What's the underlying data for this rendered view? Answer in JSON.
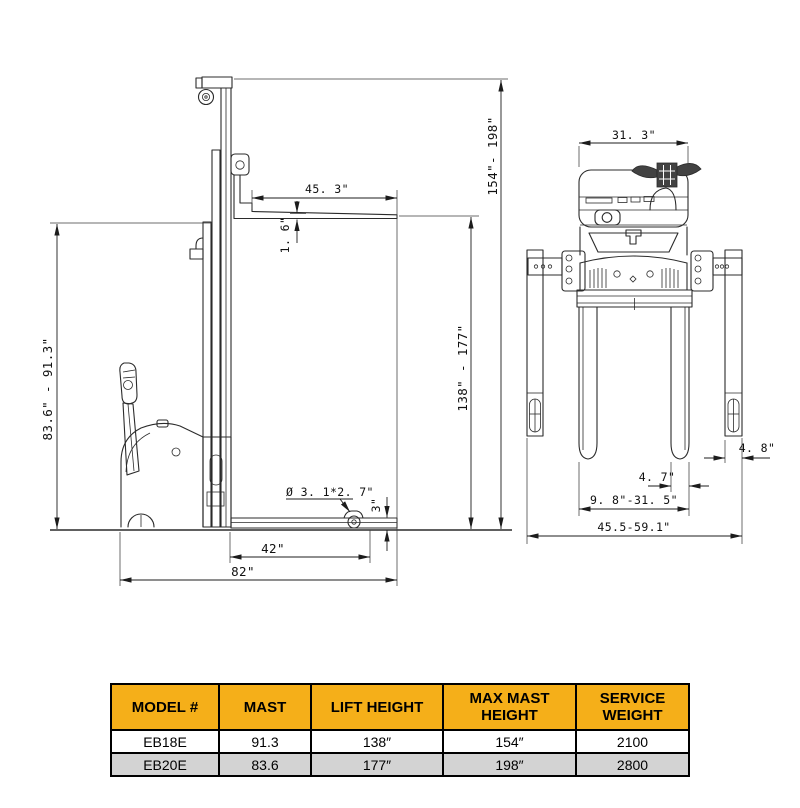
{
  "table": {
    "header_bg": "#F5AF19",
    "row_alt_bg": "#D3D3D3",
    "columns": [
      "MODEL #",
      "MAST",
      "LIFT HEIGHT",
      "MAX MAST HEIGHT",
      "SERVICE WEIGHT"
    ],
    "rows": [
      [
        "EB18E",
        "91.3",
        "138″",
        "154″",
        "2100"
      ],
      [
        "EB20E",
        "83.6",
        "177″",
        "198″",
        "2800"
      ]
    ]
  },
  "diagram": {
    "line_color": "#2b2b2b",
    "side": {
      "mast_height": "83.6\" - 91.3\"",
      "fork_length": "45. 3\"",
      "fork_thickness": "1. 6\"",
      "max_mast_height": "154\"- 198\"",
      "lift_height": "138\" - 177\"",
      "caster_size": "Ø 3. 1*2. 7\"",
      "lowered_fork_height": "3\"",
      "leg_length": "42\"",
      "overall_length": "82\""
    },
    "front": {
      "body_width": "31. 3\"",
      "leg_width": "4. 8\"",
      "fork_width": "4. 7\"",
      "fork_span": "9. 8\"-31. 5\"",
      "leg_span": "45.5-59.1\""
    }
  }
}
